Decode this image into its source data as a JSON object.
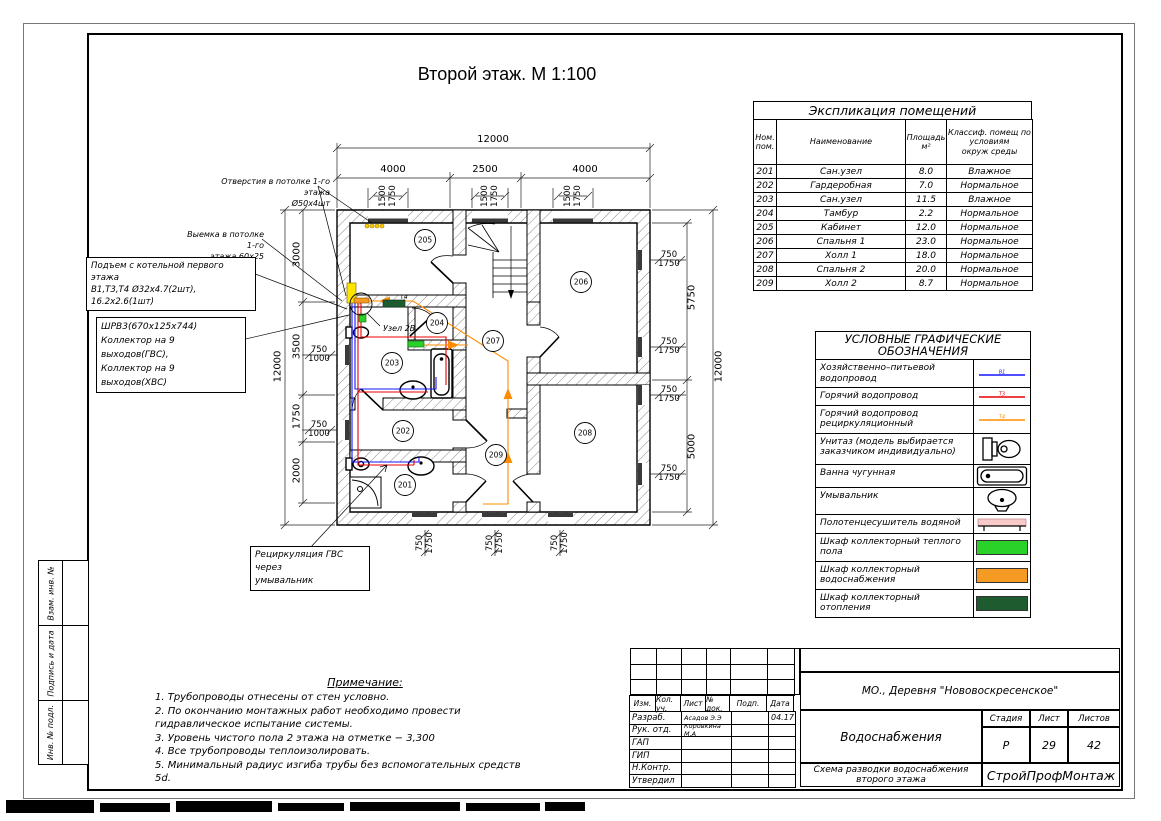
{
  "title": "Второй этаж. М 1:100",
  "explication": {
    "title": "Экспликация помещений",
    "headers": [
      "Ном.\nпом.",
      "Наименование",
      "Площадь\nм²",
      "Классиф. помещ по\nусловиям\nокруж среды"
    ],
    "rows": [
      [
        "201",
        "Сан.узел",
        "8.0",
        "Влажное"
      ],
      [
        "202",
        "Гардеробная",
        "7.0",
        "Нормальное"
      ],
      [
        "203",
        "Сан.узел",
        "11.5",
        "Влажное"
      ],
      [
        "204",
        "Тамбур",
        "2.2",
        "Нормальное"
      ],
      [
        "205",
        "Кабинет",
        "12.0",
        "Нормальное"
      ],
      [
        "206",
        "Спальня 1",
        "23.0",
        "Нормальное"
      ],
      [
        "207",
        "Холл 1",
        "18.0",
        "Нормальное"
      ],
      [
        "208",
        "Спальня 2",
        "20.0",
        "Нормальное"
      ],
      [
        "209",
        "Холл 2",
        "8.7",
        "Нормальное"
      ]
    ]
  },
  "legend": {
    "title": "УСЛОВНЫЕ ГРАФИЧЕСКИЕ\nОБОЗНАЧЕНИЯ",
    "rows": [
      {
        "label": "Хозяйственно–питьевой водопровод",
        "symbol": "line",
        "color": "#1515ff",
        "tag": "В1"
      },
      {
        "label": "Горячий водопровод",
        "symbol": "line",
        "color": "#e80000",
        "tag": "Т3"
      },
      {
        "label": "Горячий водопровод\nрециркуляционный",
        "symbol": "line",
        "color": "#ff8c00",
        "tag": "Т4"
      },
      {
        "label": "Унитаз (модель выбирается\nзаказчиком индивидуально)",
        "symbol": "toilet"
      },
      {
        "label": "Ванна чугунная",
        "symbol": "bath"
      },
      {
        "label": "Умывальник",
        "symbol": "sink"
      },
      {
        "label": "Полотенцесушитель водяной",
        "symbol": "towel",
        "color": "#f8caca"
      },
      {
        "label": "Шкаф коллекторный теплого пола",
        "symbol": "swatch",
        "color": "#29d129"
      },
      {
        "label": "Шкаф коллекторный водоснабжения",
        "symbol": "swatch",
        "color": "#f59a23"
      },
      {
        "label": "Шкаф коллекторный отопления",
        "symbol": "swatch",
        "color": "#1e5b2e"
      }
    ]
  },
  "notes": {
    "title": "Примечание:",
    "items": [
      "1. Трубопроводы отнесены от стен  условно.",
      "2. По окончанию монтажных работ необходимо провести гидравлическое испытание системы.",
      "3. Уровень чистого пола 2 этажа на отметке −  3,300",
      "4. Все трубопроводы теплоизолировать.",
      "5. Минимальный радиус изгиба трубы без вспомогательных средств 5d."
    ]
  },
  "callouts": {
    "holes": [
      "Отверстия в потолке 1-го этажа",
      "Ø50х4шт"
    ],
    "recess": [
      "Выемка в потолке 1-го",
      "этажа 60х25"
    ],
    "riser": [
      "Подъем с котельной первого этажа",
      "В1,Т3,Т4 Ø32х4.7(2шт), 16.2х2.6(1шт)"
    ],
    "cabinet": [
      "ШРВ3(670х125х744)",
      "Коллектор на 9 выходов(ГВС),",
      "Коллектор на 9 выходов(ХВС)"
    ],
    "recirc": [
      "Рециркуляция ГВС через",
      "умывальник"
    ]
  },
  "plan": {
    "rooms": [
      "205",
      "206",
      "204",
      "207",
      "203",
      "202",
      "209",
      "208",
      "201"
    ],
    "uzel_label": "Узел 2В",
    "t4_label": "Т4"
  },
  "dims": {
    "overall": "12000",
    "top_bays": [
      "4000",
      "2500",
      "4000"
    ],
    "top_window": [
      "1500",
      "1750"
    ],
    "left_chain": [
      "3000",
      "3500",
      "1750",
      "2000"
    ],
    "left_window": [
      "750",
      "1000"
    ],
    "right_chain": [
      "5750",
      "5000"
    ],
    "right_window": [
      "750",
      "1750"
    ],
    "bottom_window": [
      "750",
      "1750"
    ]
  },
  "titleblock": {
    "location": "МО., Деревня \"Нововоскресенское\"",
    "header_cols": [
      "Изм.",
      "Кол. уч.",
      "Лист",
      "№ док.",
      "Подп.",
      "Дата"
    ],
    "staff": [
      {
        "role": "Разраб.",
        "name": "Асадов Э.Э",
        "date": "04.17"
      },
      {
        "role": "Рук. отд.",
        "name": "Коровкина М.А",
        "date": ""
      },
      {
        "role": "ГАП",
        "name": "",
        "date": ""
      },
      {
        "role": "ГИП",
        "name": "",
        "date": ""
      },
      {
        "role": "Н.Контр.",
        "name": "",
        "date": ""
      },
      {
        "role": "Утвердил",
        "name": "",
        "date": ""
      }
    ],
    "doc_title": "Водоснабжения",
    "stage_label": "Стадия",
    "sheet_label": "Лист",
    "sheets_label": "Листов",
    "stage": "Р",
    "sheet": "29",
    "sheets": "42",
    "drawing_title": [
      "Схема разводки водоснабжения",
      "второго этажа"
    ],
    "company": "СтройПрофМонтаж"
  },
  "side_labels": [
    "Взам. инв. №",
    "Подпись и дата",
    "Инв. № подл."
  ],
  "colors": {
    "cold_water": "#1515ff",
    "hot_water": "#e80000",
    "recirculation": "#ff8c00",
    "riser_marker": "#ffe400",
    "floor_heating_cabinet": "#29d129",
    "water_supply_cabinet": "#f59a23",
    "heating_cabinet": "#1e5b2e"
  }
}
